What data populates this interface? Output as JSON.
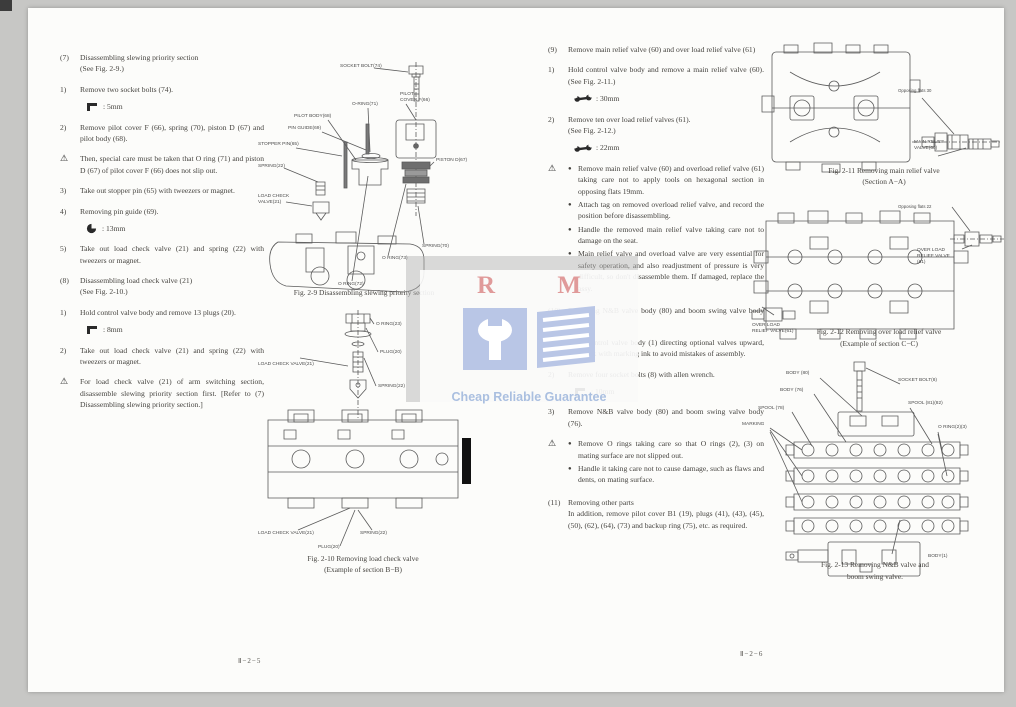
{
  "ui": {
    "bullet": "●"
  },
  "footer": {
    "left": "Ⅱ−2−5",
    "right": "Ⅱ−2−6"
  },
  "watermark": {
    "initials": "R M",
    "tagline": "Cheap Reliable Guarantee"
  },
  "left": {
    "blocks": [
      {
        "m": "(7)",
        "t": "Disassembling slewing priority section\n(See Fig. 2-9.)"
      },
      {
        "m": "1)",
        "t": "Remove two socket bolts (74)."
      },
      {
        "tool": "hex-key",
        "t": ": 5mm"
      },
      {
        "m": "2)",
        "t": "Remove pilot cover F (66), spring (70), piston D (67) and pilot body (68)."
      },
      {
        "m": "⚠",
        "t": "Then, special care must be taken that O ring (71) and piston D (67) of pilot cover F (66) does not slip out."
      },
      {
        "m": "3)",
        "t": "Take out stopper pin (65) with tweezers or magnet."
      },
      {
        "m": "4)",
        "t": "Removing pin guide (69)."
      },
      {
        "tool": "socket",
        "t": ": 13mm"
      },
      {
        "m": "5)",
        "t": "Take out load check valve (21) and spring (22) with tweezers or magnet."
      },
      {
        "m": "(8)",
        "t": "Disassembling load check valve (21)\n(See Fig. 2-10.)"
      },
      {
        "m": "1)",
        "t": "Hold control valve body and remove 13 plugs (20)."
      },
      {
        "tool": "hex-key",
        "t": ": 8mm"
      },
      {
        "m": "2)",
        "t": "Take out load check valve (21) and spring (22) with tweezers or magnet."
      },
      {
        "m": "⚠",
        "t": "For load check valve (21) of arm switching section, disassemble slewing priority section first. [Refer to (7) Disassembling slewing priority section.]"
      }
    ]
  },
  "mid": {
    "blocks": [
      {
        "m": "(9)",
        "t": "Remove main relief valve (60) and over load relief valve (61)"
      },
      {
        "m": "1)",
        "t": "Hold control valve body and remove a main relief valve (60). (See Fig. 2-11.)"
      },
      {
        "tool": "spanner",
        "t": ": 30mm"
      },
      {
        "m": "2)",
        "t": "Remove ten over load relief valves (61).\n(See Fig. 2-12.)"
      },
      {
        "tool": "spanner",
        "t": ": 22mm"
      },
      {
        "m": "⚠",
        "bullets": [
          "Remove main relief valve (60) and overload relief valve (61) taking care not to apply tools on hexagonal section in opposing flats 19mm.",
          "Attach tag on removed overload relief valve, and record the position before disassembling.",
          "Handle the removed main relief valve taking care not to damage on the seat.",
          "Main relief valve and overload valve are very essential for safety operation, and also readjustment of pressure is very difficult, so don't disassemble them. If damaged, replace the assy."
        ]
      },
      {
        "m": "(10)",
        "t": "Removing N&B valve body (80) and boom swing valve body (76)"
      },
      {
        "m": "1)",
        "t": "Place control valve body (1) directing optional valves upward, and mark with marking ink to avoid mistakes of assembly."
      },
      {
        "m": "2)",
        "t": "Remove four socket bolts (8) with allen wrench."
      },
      {
        "tool": "hex-key",
        "t": ": 10mm"
      },
      {
        "m": "3)",
        "t": "Remove N&B valve body (80) and boom swing valve body (76)."
      },
      {
        "m": "⚠",
        "bullets": [
          "Remove O rings taking care so that O rings (2), (3) on mating surface are not slipped out.",
          "Handle it taking care not to cause damage, such as flaws and dents, on mating surface."
        ]
      },
      {
        "m": "(11)",
        "t": "Removing other parts\nIn addition, remove pilot cover B1 (19), plugs (41), (43), (45), (50), (62), (64), (73) and backup ring (75), etc. as required."
      }
    ]
  },
  "figures": {
    "fig2_9": {
      "caption": "Fig. 2-9   Disassembling slewing priority section",
      "labels": {
        "socket_bolt": "SOCKET BOLT(74)",
        "pilot_cover": "PILOT\nCOVER F(66)",
        "o_ring_71": "O-RING(71)",
        "pilot_body": "PILOT BODY(68)",
        "pin_guide": "PIN GUIDE(69)",
        "stopper_pin": "STOPPER PIN(65)",
        "spring_22": "SPRING(22)",
        "load_check_valve": "LOAD CHECK\nVALVE(21)",
        "piston_d": "PISTON D(67)",
        "spring_70": "SPRING(70)",
        "o_ring_73": "O RING(73)",
        "o_ring_72": "O RING(72)"
      }
    },
    "fig2_10": {
      "caption_1": "Fig. 2-10   Removing load check valve",
      "caption_2": "(Example of section B−B)",
      "labels": {
        "o_ring_23": "O RING(23)",
        "plug_top": "PLUG(20)",
        "spring_top": "SPRING(22)",
        "load_check_top": "LOAD CHECK VALVE(21)",
        "load_check_bottom": "LOAD CHECK VALVE(21)",
        "spring_bottom": "SPRING(22)",
        "plug_bottom": "PLUG(20)"
      }
    },
    "fig2_11": {
      "caption_1": "Fig. 2-11   Removing main relief valve",
      "caption_2": "(Section A−A)",
      "labels": {
        "opposing_flats": "Opposing flats 30",
        "main_relief": "MAIN RELIEF\nVALVE(60)"
      }
    },
    "fig2_12": {
      "caption_1": "Fig. 2-12   Removing over load relief valve",
      "caption_2": "(Example of section C−C)",
      "labels": {
        "opposing_flats": "Opposing flats 22",
        "overload_right": "OVER LOAD\nRELIEF VALVE\n(61)",
        "overload_left": "OVER LOAD\nRELIEF VALVE(61)"
      }
    },
    "fig2_13": {
      "caption_1": "Fig. 2-13   Removing N&B valve and",
      "caption_2": "boom swing valve.",
      "labels": {
        "body_80": "BODY (80)",
        "body_76": "BODY (76)",
        "spool_78": "SPOOL (78)",
        "socket_bolt_8": "SOCKET BOLT(8)",
        "spool_81_82": "SPOOL (81)(82)",
        "marking": "MARKING",
        "o_ring_2_3": "O RING(2)(3)",
        "body_1": "BODY(1)"
      }
    }
  }
}
